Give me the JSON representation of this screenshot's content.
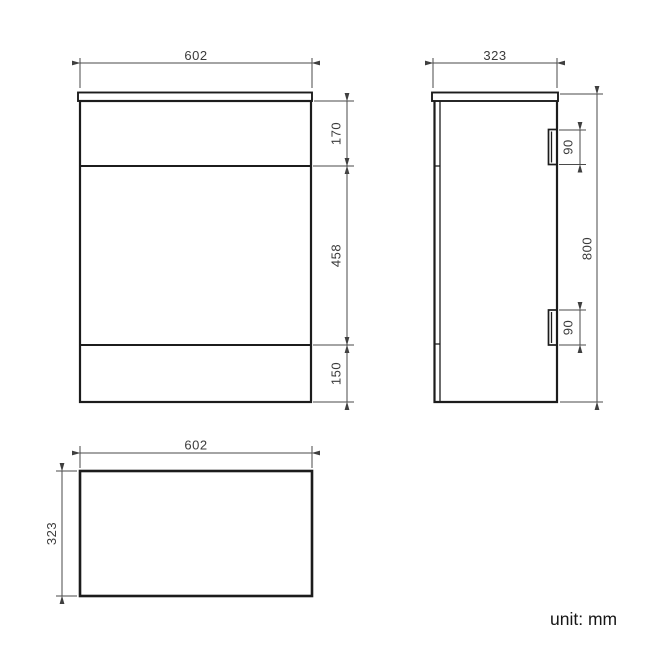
{
  "drawing": {
    "unit_note": "unit: mm",
    "front_view": {
      "width": "602",
      "top_section_height": "170",
      "middle_section_height": "458",
      "bottom_section_height": "150"
    },
    "side_view": {
      "depth": "323",
      "overall_height": "800",
      "top_hinge_height": "90",
      "bottom_hinge_height": "90"
    },
    "plan_view": {
      "width": "602",
      "depth": "323"
    }
  },
  "colors": {
    "object_line": "#1c1c1c",
    "dimension_line": "#4a4a4a",
    "background": "#ffffff"
  }
}
